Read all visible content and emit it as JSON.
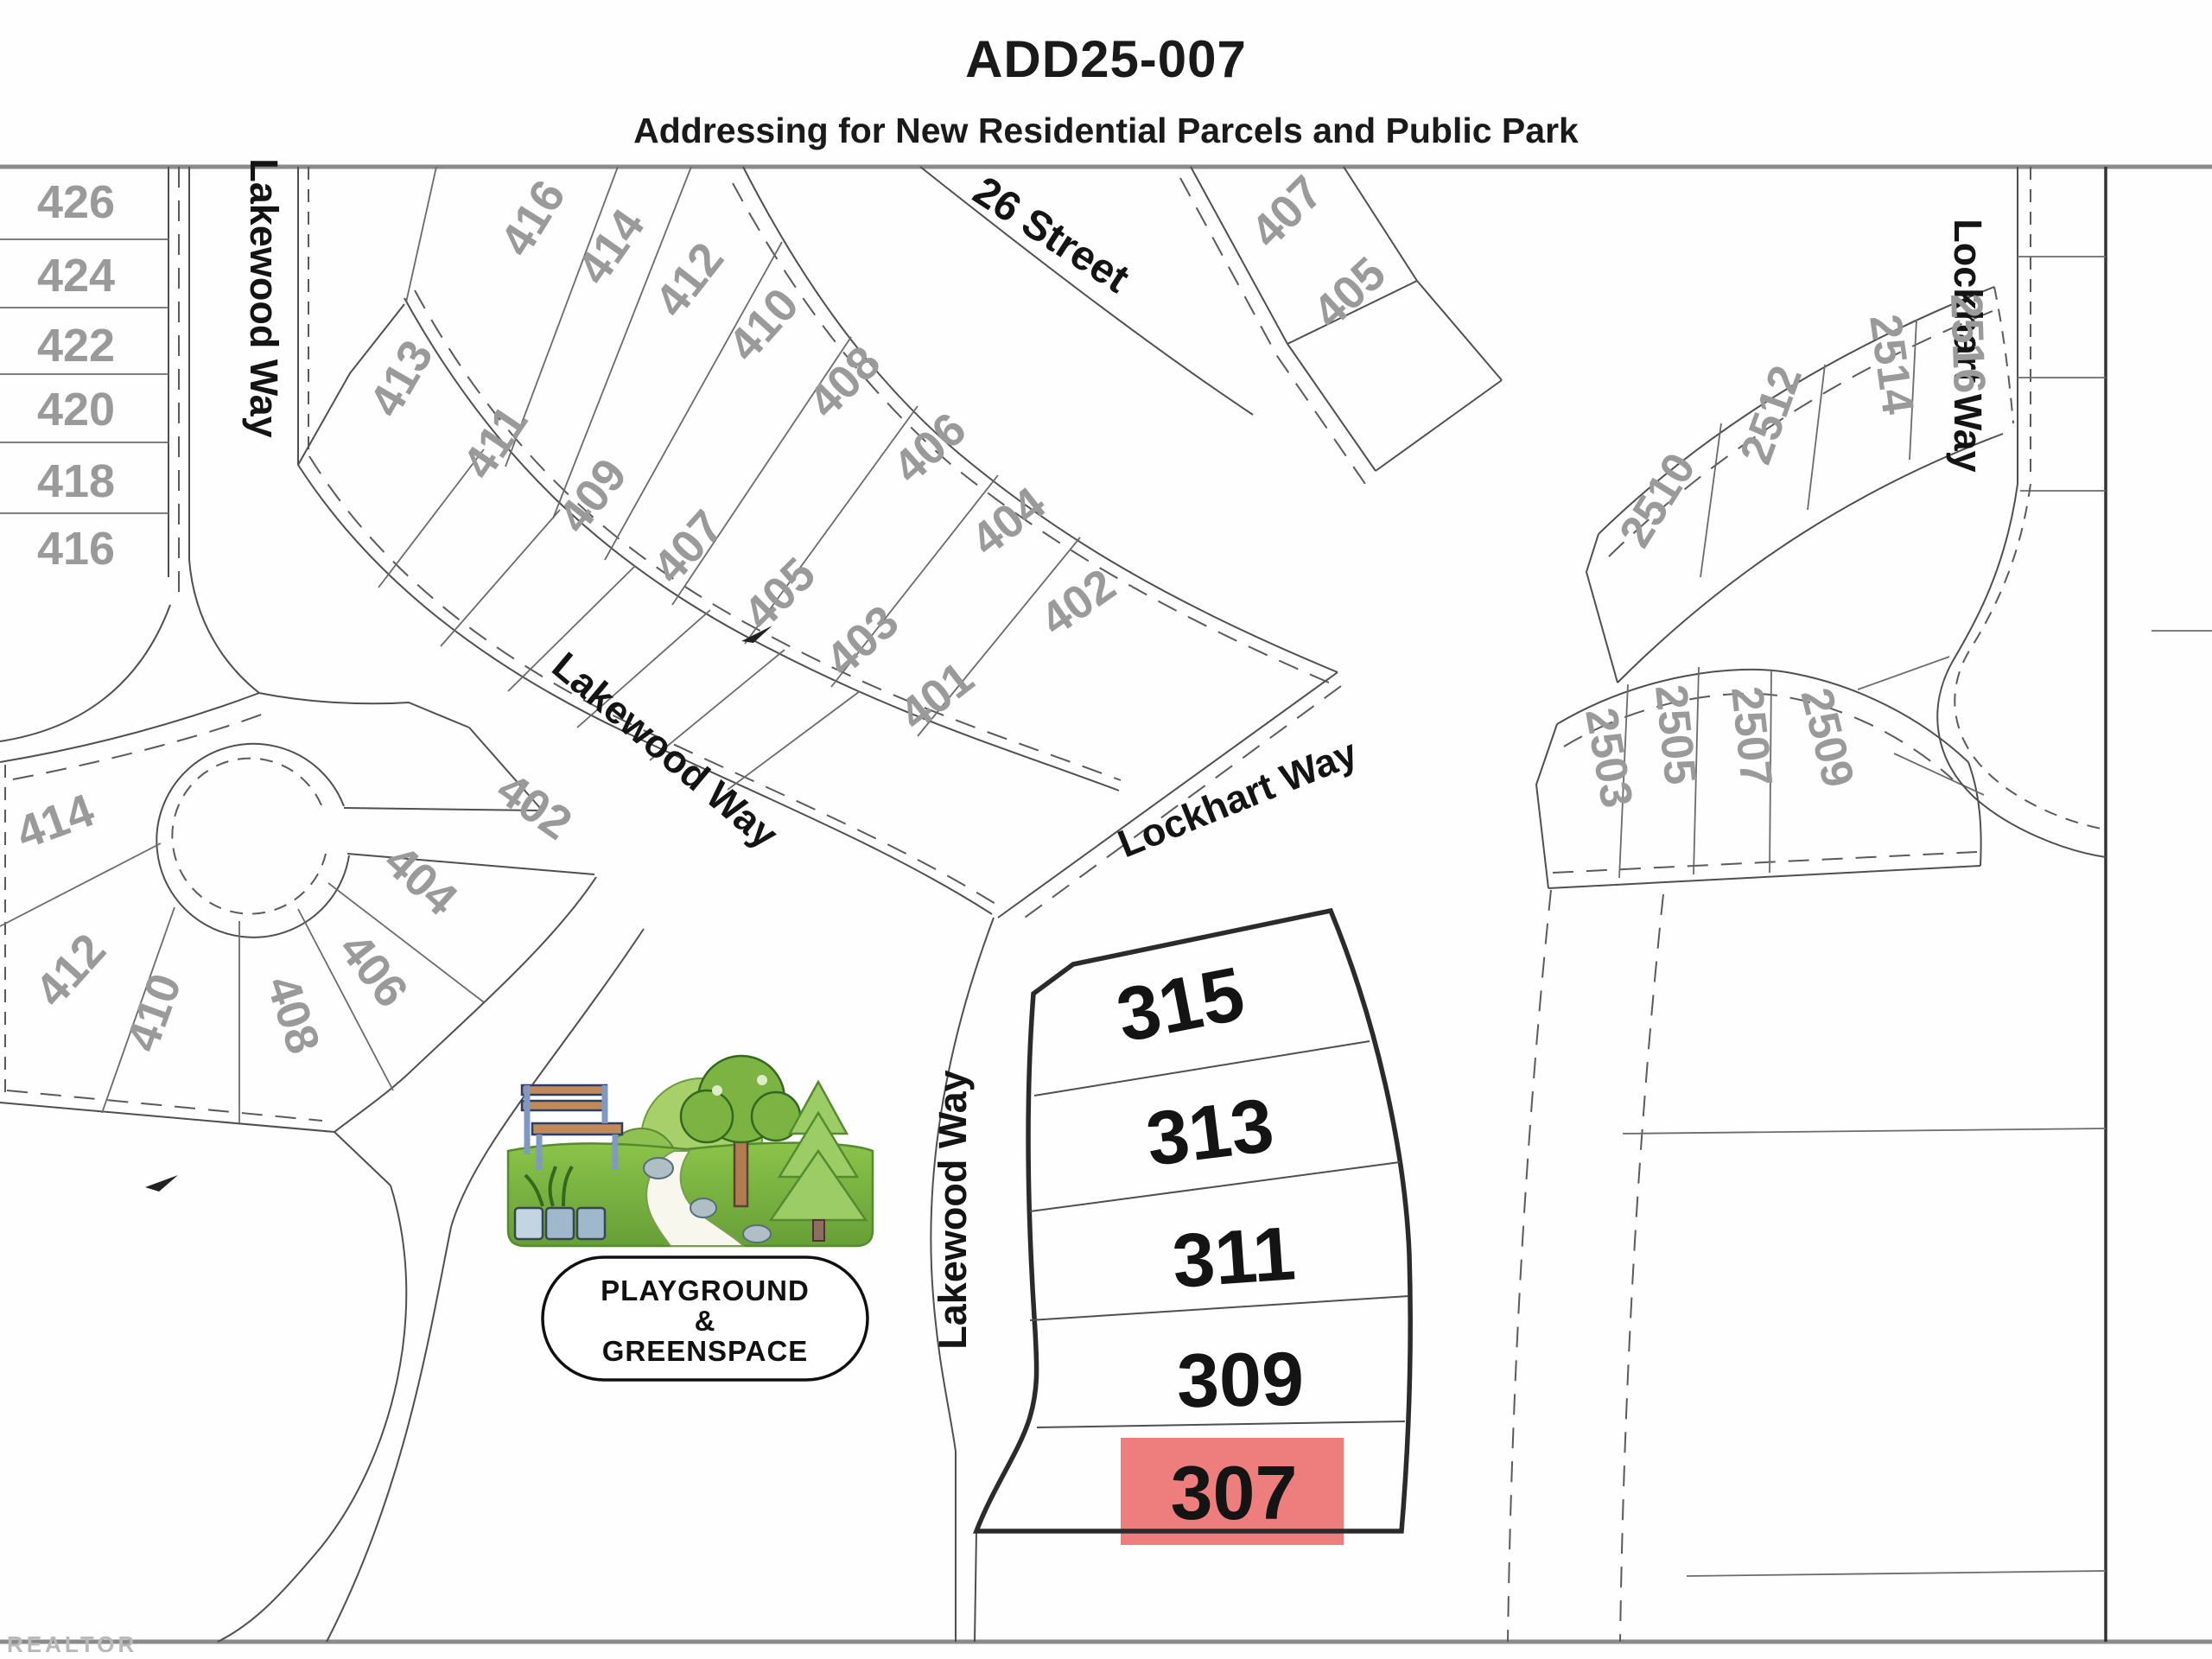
{
  "header": {
    "title": "ADD25-007",
    "subtitle": "Addressing for New Residential Parcels and Public Park"
  },
  "streets": {
    "s26": "26 Street",
    "lakewood_west": "Lakewood Way",
    "lakewood_diag": "Lakewood Way",
    "lakewood_central": "Lakewood Way",
    "lockhart_diag": "Lockhart Way",
    "lockhart_ne": "Lockhart Way"
  },
  "parcels": {
    "left_column": [
      "426",
      "424",
      "422",
      "420",
      "418",
      "416"
    ],
    "crescent_outer": [
      "416",
      "414",
      "412",
      "410",
      "408",
      "406",
      "404",
      "402"
    ],
    "crescent_inner": [
      "413",
      "411",
      "409",
      "407",
      "405",
      "403",
      "401"
    ],
    "culdesac": [
      "414",
      "412",
      "410",
      "408",
      "406",
      "404",
      "402"
    ],
    "ne_pair": [
      "407",
      "405"
    ],
    "block_2510": [
      "2510",
      "2512",
      "2514",
      "2516"
    ],
    "block_2500": [
      "2503",
      "2505",
      "2507",
      "2509"
    ],
    "central": [
      "315",
      "313",
      "311",
      "309"
    ],
    "highlighted": "307"
  },
  "park": {
    "line1": "PLAYGROUND",
    "line2": "&",
    "line3": "GREENSPACE"
  },
  "highlight": {
    "bg": "#ee7e7e",
    "text": "#a8433e"
  },
  "watermark": "REALTOR"
}
